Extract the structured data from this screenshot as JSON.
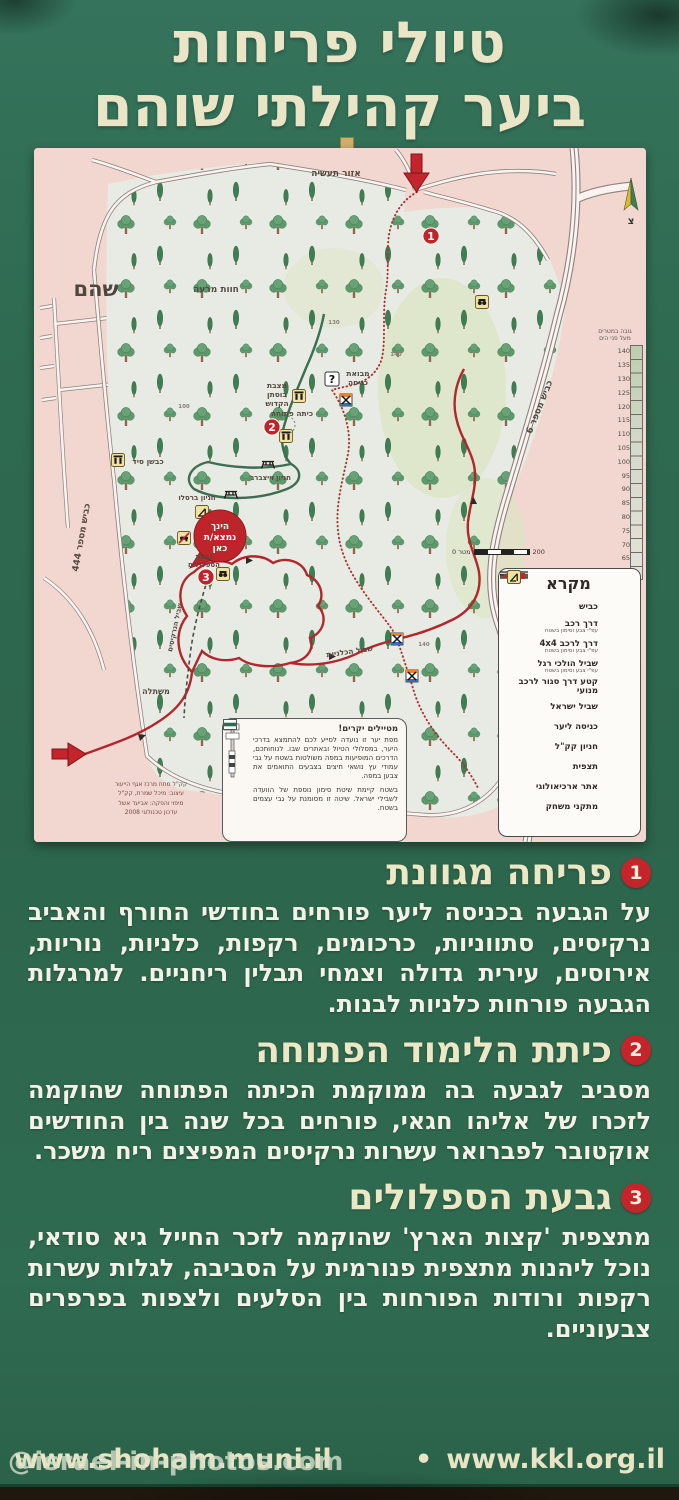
{
  "title": {
    "line1": "טיולי פריחות",
    "line2": "ביער קהילתי שוהם"
  },
  "map": {
    "town_label": "שהם",
    "industrial_label": "אזור תעשיה",
    "compass_label": "צ",
    "question_glyph": "?",
    "four_by_four": "4x4",
    "roads": {
      "road444": "כביש מספר 444",
      "road6": "כביש מספר 6"
    },
    "spot_heights": [
      "140",
      "130",
      "140",
      "100"
    ],
    "labels": {
      "grazing": "חוות מרעה",
      "entry_plaza_1": "מבואת",
      "entry_plaza_2": "כניסה",
      "bustan_1": "מצבת",
      "bustan_2": "בוסתן",
      "bustan_3": "הקדוש",
      "open_class": "כיתה פתוחה",
      "weinberg": "חניון וייצברג",
      "breslov": "חניון ברסלו",
      "you_are_here_1": "הינך",
      "you_are_here_2": "נמצא/ת",
      "you_are_here_3": "כאן",
      "hill_1": "גבעת",
      "hill_2": "הספלולים",
      "anemone_trail": "שביל הכלניות",
      "narcissus_trail": "שביל הנרקיסים",
      "nursery": "משתלה",
      "lime_kiln": "כבשן סיד"
    },
    "markers": {
      "m1": "1",
      "m2": "2",
      "m3": "3"
    },
    "elevation": {
      "title_line1": "גובה במטרים",
      "title_line2": "מעל פני הים",
      "ticks": [
        "140",
        "135",
        "130",
        "125",
        "120",
        "115",
        "110",
        "105",
        "100",
        "95",
        "90",
        "85",
        "80",
        "75",
        "70",
        "65",
        "60"
      ]
    },
    "scale": {
      "left": "0",
      "unit": "מטר",
      "right": "200"
    },
    "legend": {
      "title": "מקרא",
      "items": [
        {
          "label": "כביש",
          "sub": ""
        },
        {
          "label": "דרך רכב",
          "sub": "עפ\"י צבע וסימון בשטח"
        },
        {
          "label": "דרך לרכב 4x4",
          "sub": "עפ\"י צבע וסימון בשטח"
        },
        {
          "label": "שביל הולכי רגל",
          "sub": "עפ\"י צבע וסימון בשטח"
        },
        {
          "label": "קטע דרך סגור לרכב מנועי",
          "sub": ""
        },
        {
          "label": "שביל ישראל",
          "sub": ""
        },
        {
          "label": "כניסה ליער",
          "sub": ""
        },
        {
          "label": "חניון קק\"ל",
          "sub": ""
        },
        {
          "label": "תצפית",
          "sub": ""
        },
        {
          "label": "אתר ארכיאולוגי",
          "sub": ""
        },
        {
          "label": "מתקני משחק",
          "sub": ""
        }
      ]
    },
    "info_box": {
      "title": "מטיילים יקרים!",
      "p1": "מפת יער זו נועדה לסייע לכם להתמצא בדרכי היער, במסלולי הטיול ובאתרים שבו. לנוחותכם, הדרכים המופיעות במפה משולטות בשטח על גבי עמודי עץ נושאי חיצים בצבעים התואמים את צבען במפה.",
      "p2": "בשטח קיימת שיטת סימון נוספת של הוועדה לשבילי ישראל. שיטה זו מסומנת על גבי עצמים בשטח."
    },
    "credits": [
      "קק\"ל מחוז מרכז אגף הייעור",
      "עיצוב: מיכל שמרת, קק\"ל",
      "מיפוי והפקה: אביעד אשל",
      "עדכון טכנולוגי 2008"
    ]
  },
  "sections": [
    {
      "num": "1",
      "title": "פריחה מגוונת",
      "body": "על הגבעה בכניסה ליער פורחים בחודשי החורף והאביב נרקיסים, סתווניות, כרכומים, רקפות, כלניות, נוריות, אירוסים, עירית גדולה וצמחי תבלין ריחניים. למרגלות הגבעה פורחות כלניות לבנות."
    },
    {
      "num": "2",
      "title": "כיתת הלימוד הפתוחה",
      "body": "מסביב לגבעה בה ממוקמת הכיתה הפתוחה שהוקמה לזכרו של אליהו חגאי, פורחים בכל שנה בין החודשים אוקטובר לפברואר עשרות נרקיסים המפיצים ריח משכר."
    },
    {
      "num": "3",
      "title": "גבעת הספלולים",
      "body": "מתצפית 'קצות הארץ' שהוקמה לזכר החייל גיא סודאי, נוכל ליהנות מתצפית פנורמית על הסביבה, לגלות עשרות רקפות ורודות הפורחות בין הסלעים ולצפות בפרפרים צבעוניים."
    }
  ],
  "footer": {
    "site1": "www.shoham.muni.il",
    "separator": "•",
    "site2": "www.kkl.org.il",
    "watermark": "@israel-in-photos.com"
  },
  "colors": {
    "sign_green": "#2f6b51",
    "cream": "#eae5c6",
    "marker_red": "#c5242b",
    "map_pink": "#f1d7cf",
    "forest": "#e8ebe4",
    "trail_red": "#b3262c",
    "trail_green": "#3c6e52"
  }
}
